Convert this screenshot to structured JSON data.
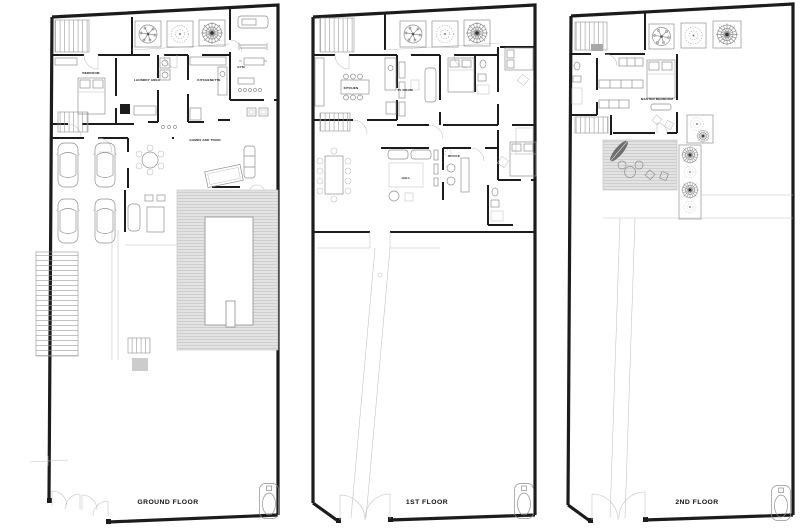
{
  "colors": {
    "wall": "#1c1c1c",
    "line": "#8f8f8f",
    "light": "#bfbfbf",
    "deck": "#e3e3e3",
    "text": "#111111",
    "bg": "#ffffff"
  },
  "plans": [
    {
      "title": "GROUND FLOOR",
      "rooms": {
        "bedroom": "BEDROOM",
        "laundry": "LAUNDRY AREA",
        "kitchenette": "KITCHENETTE",
        "gym": "GYM",
        "games": "GAMES AND TRAIN"
      }
    },
    {
      "title": "1ST FLOOR",
      "rooms": {
        "kitchen": "KITCHEN",
        "tv_room": "TV ROOM",
        "office": "OFFICE",
        "hall": "HALL"
      }
    },
    {
      "title": "2ND FLOOR",
      "rooms": {
        "master_bedroom": "MASTER BEDROOM"
      }
    }
  ]
}
